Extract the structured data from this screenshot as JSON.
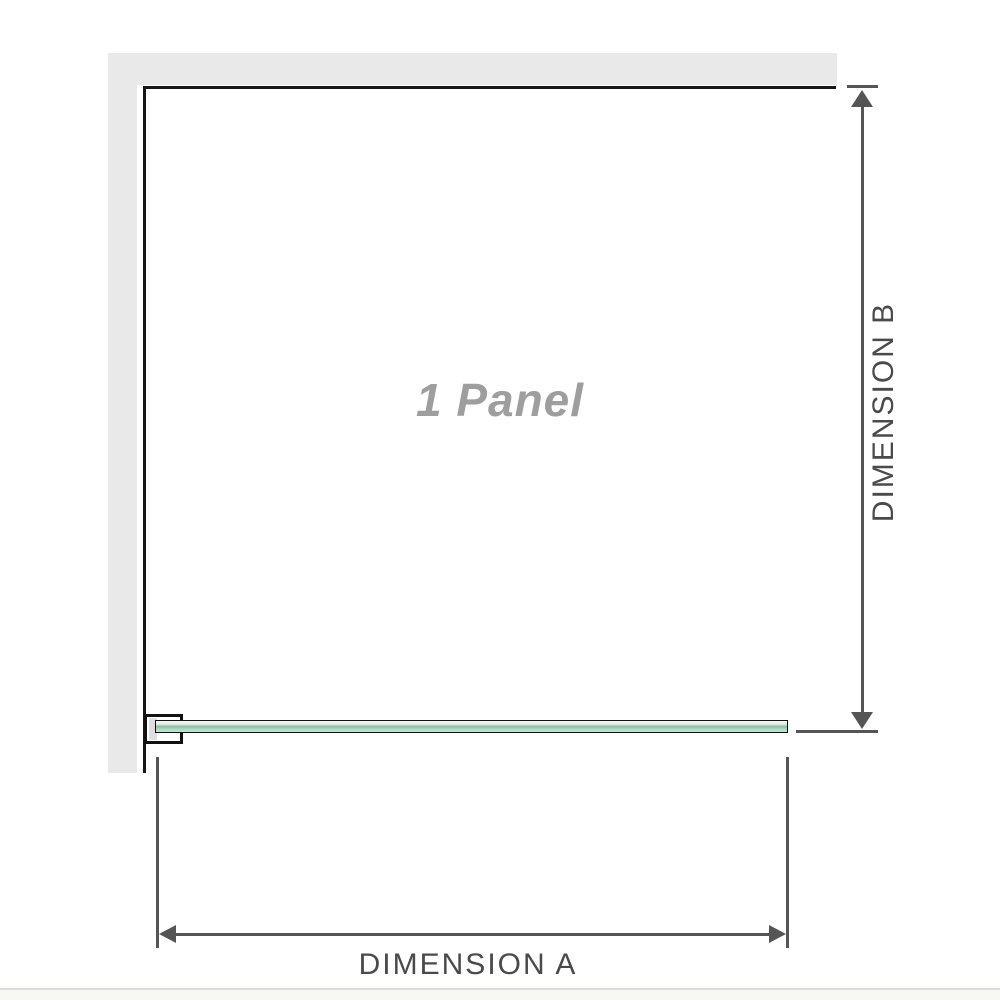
{
  "diagram": {
    "panel": {
      "label": "1 Panel"
    },
    "dimension_a": {
      "label": "DIMENSION A"
    },
    "dimension_b": {
      "label": "DIMENSION B"
    },
    "colors": {
      "wall": "#e9e9e9",
      "panel_outline": "#161616",
      "glass_green_light": "#d9efe3",
      "glass_green_mid": "#8fb3a0",
      "glass_green_low": "#c6e9d4",
      "dimension_lines": "#555555",
      "dimension_label_text": "#4a4a4a",
      "panel_label_text": "#9e9e9e",
      "divider": "#dcdcda"
    }
  }
}
